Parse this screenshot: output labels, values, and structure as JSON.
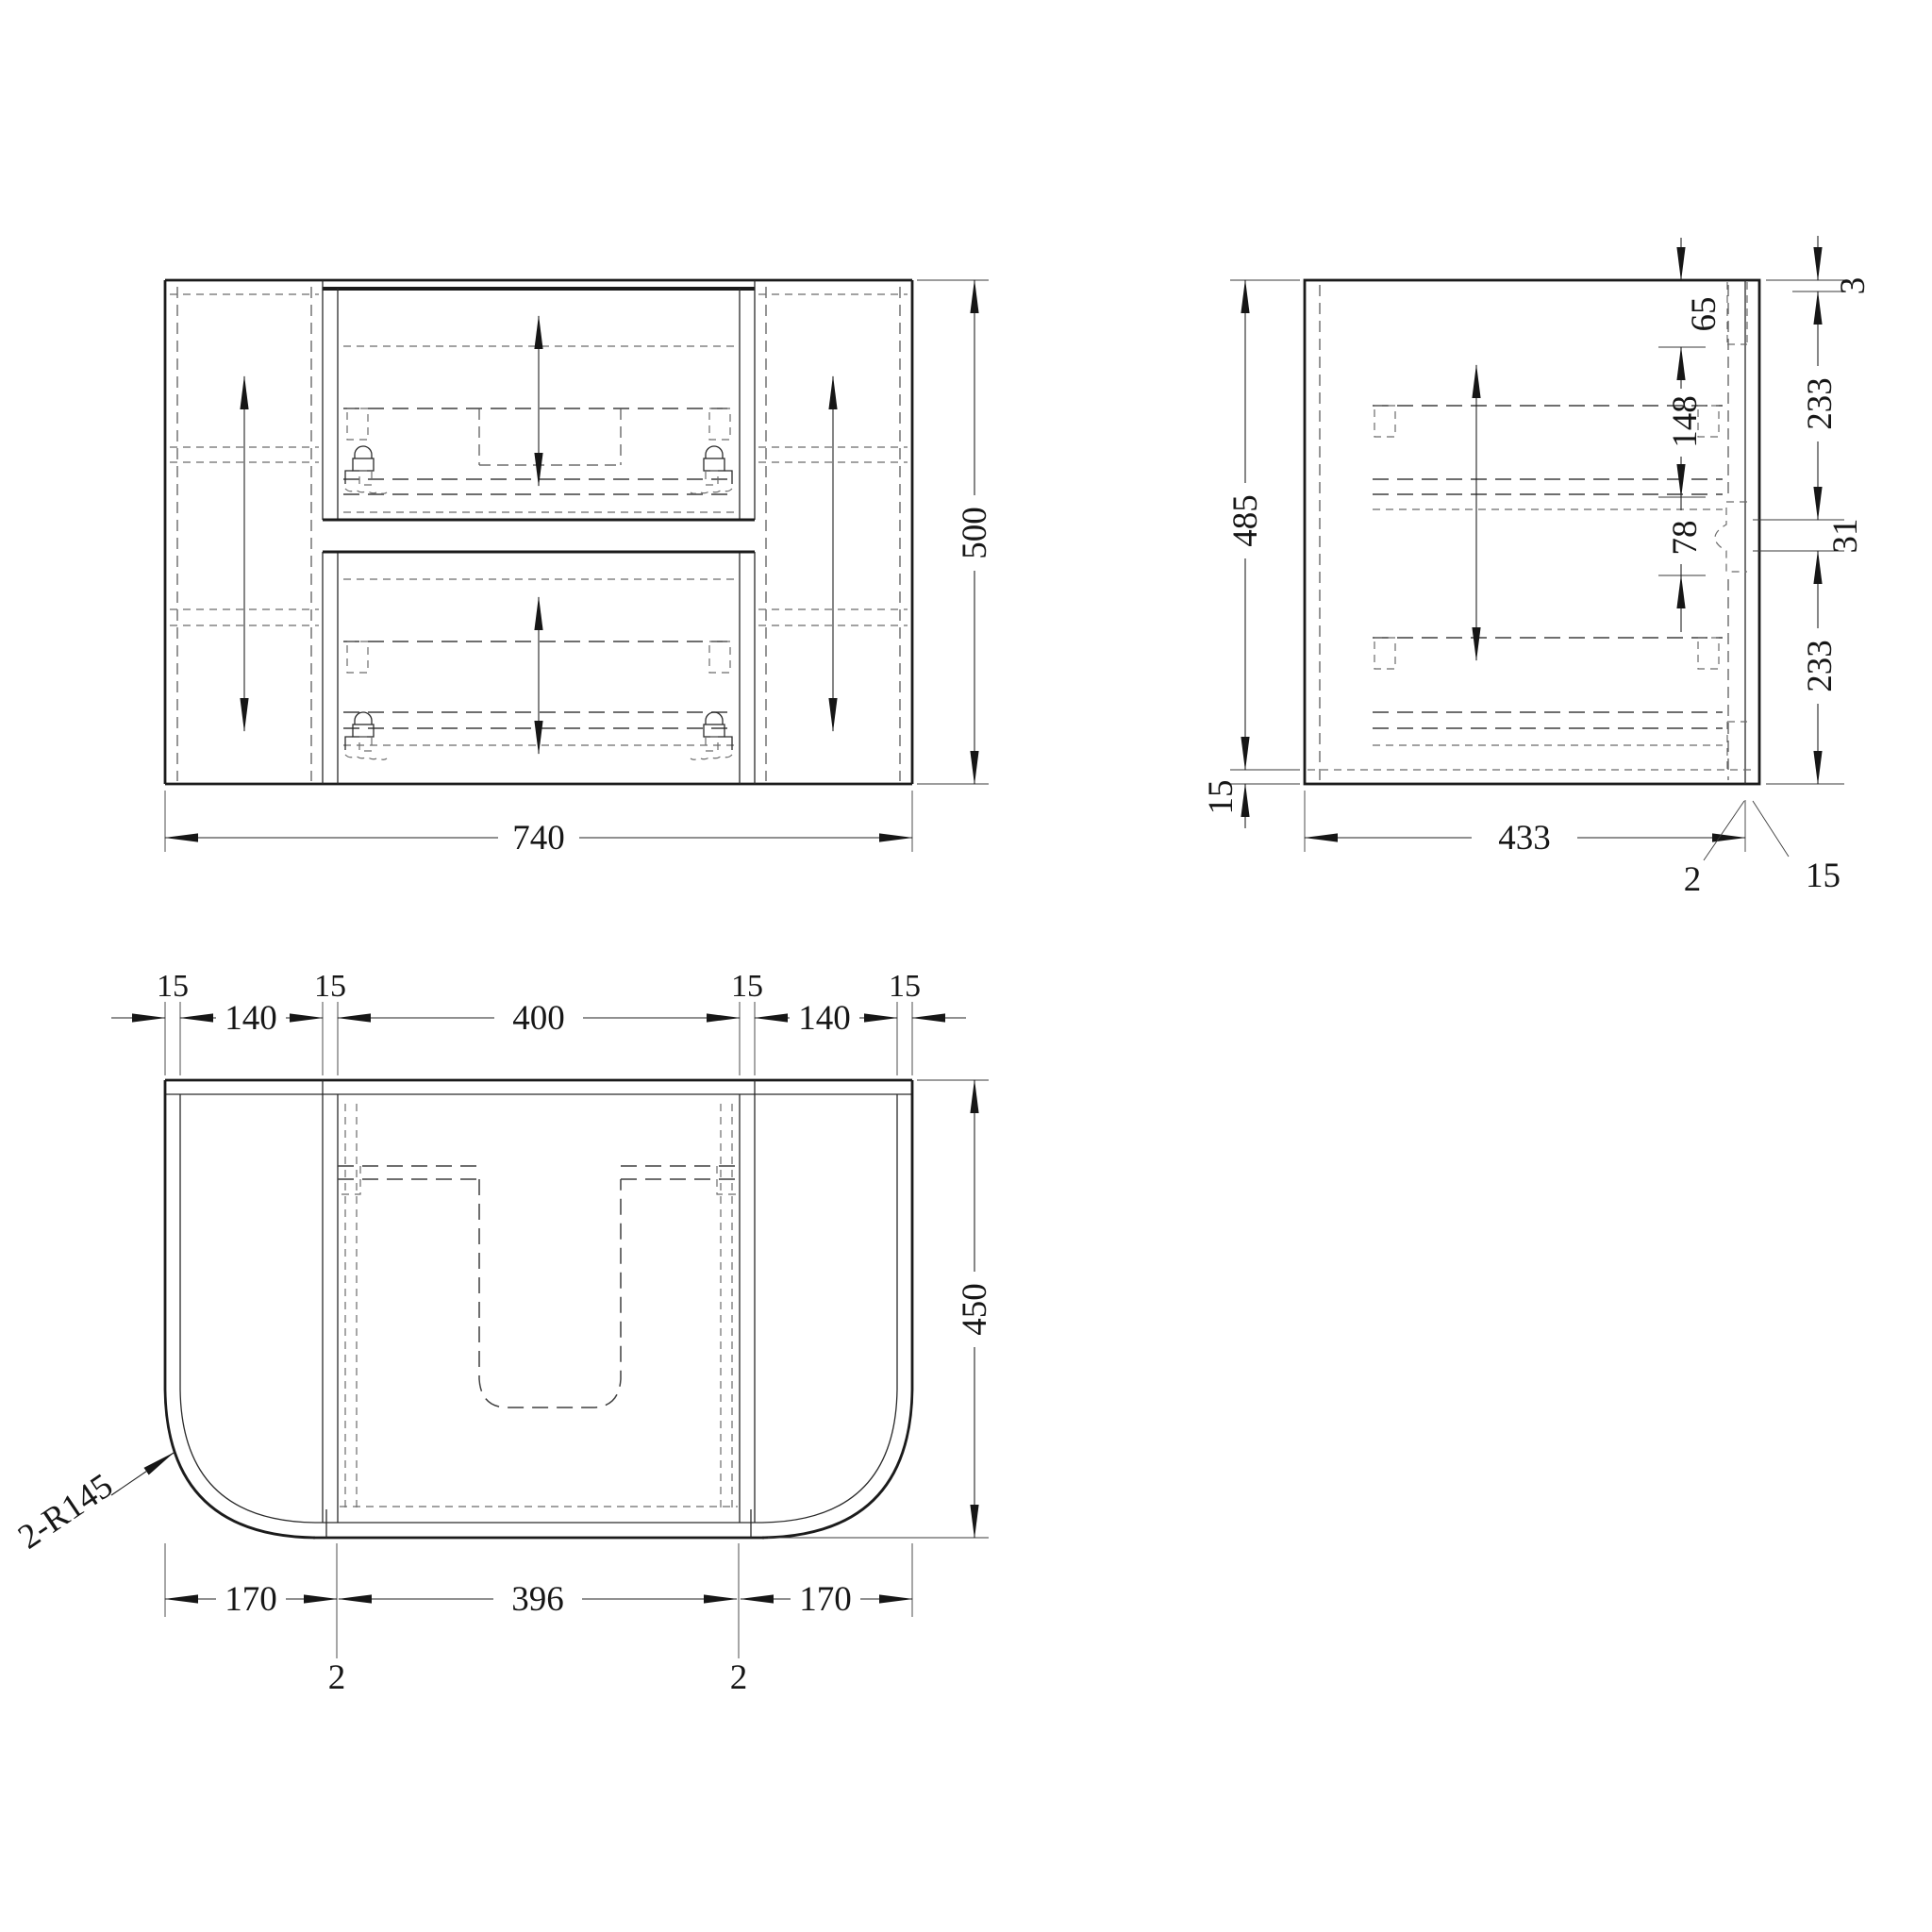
{
  "drawing": {
    "background": "#ffffff",
    "line_color": "#1b1b1b",
    "front": {
      "width": "740",
      "height": "500"
    },
    "side": {
      "height": "485",
      "bottom_panel": "15",
      "depth": "433",
      "front_gap": "2",
      "front_panel": "15",
      "top_thickness": "3",
      "upper_front": "233",
      "mid_gap": "31",
      "lower_front": "233",
      "top_rail": "65",
      "box_height": "148",
      "box_gap": "78"
    },
    "plan": {
      "top_dims": [
        "15",
        "140",
        "15",
        "400",
        "15",
        "140",
        "15"
      ],
      "depth": "450",
      "bottom_dims": [
        "170",
        "2",
        "396",
        "2",
        "170"
      ],
      "radius_callout": "2-R145"
    }
  }
}
